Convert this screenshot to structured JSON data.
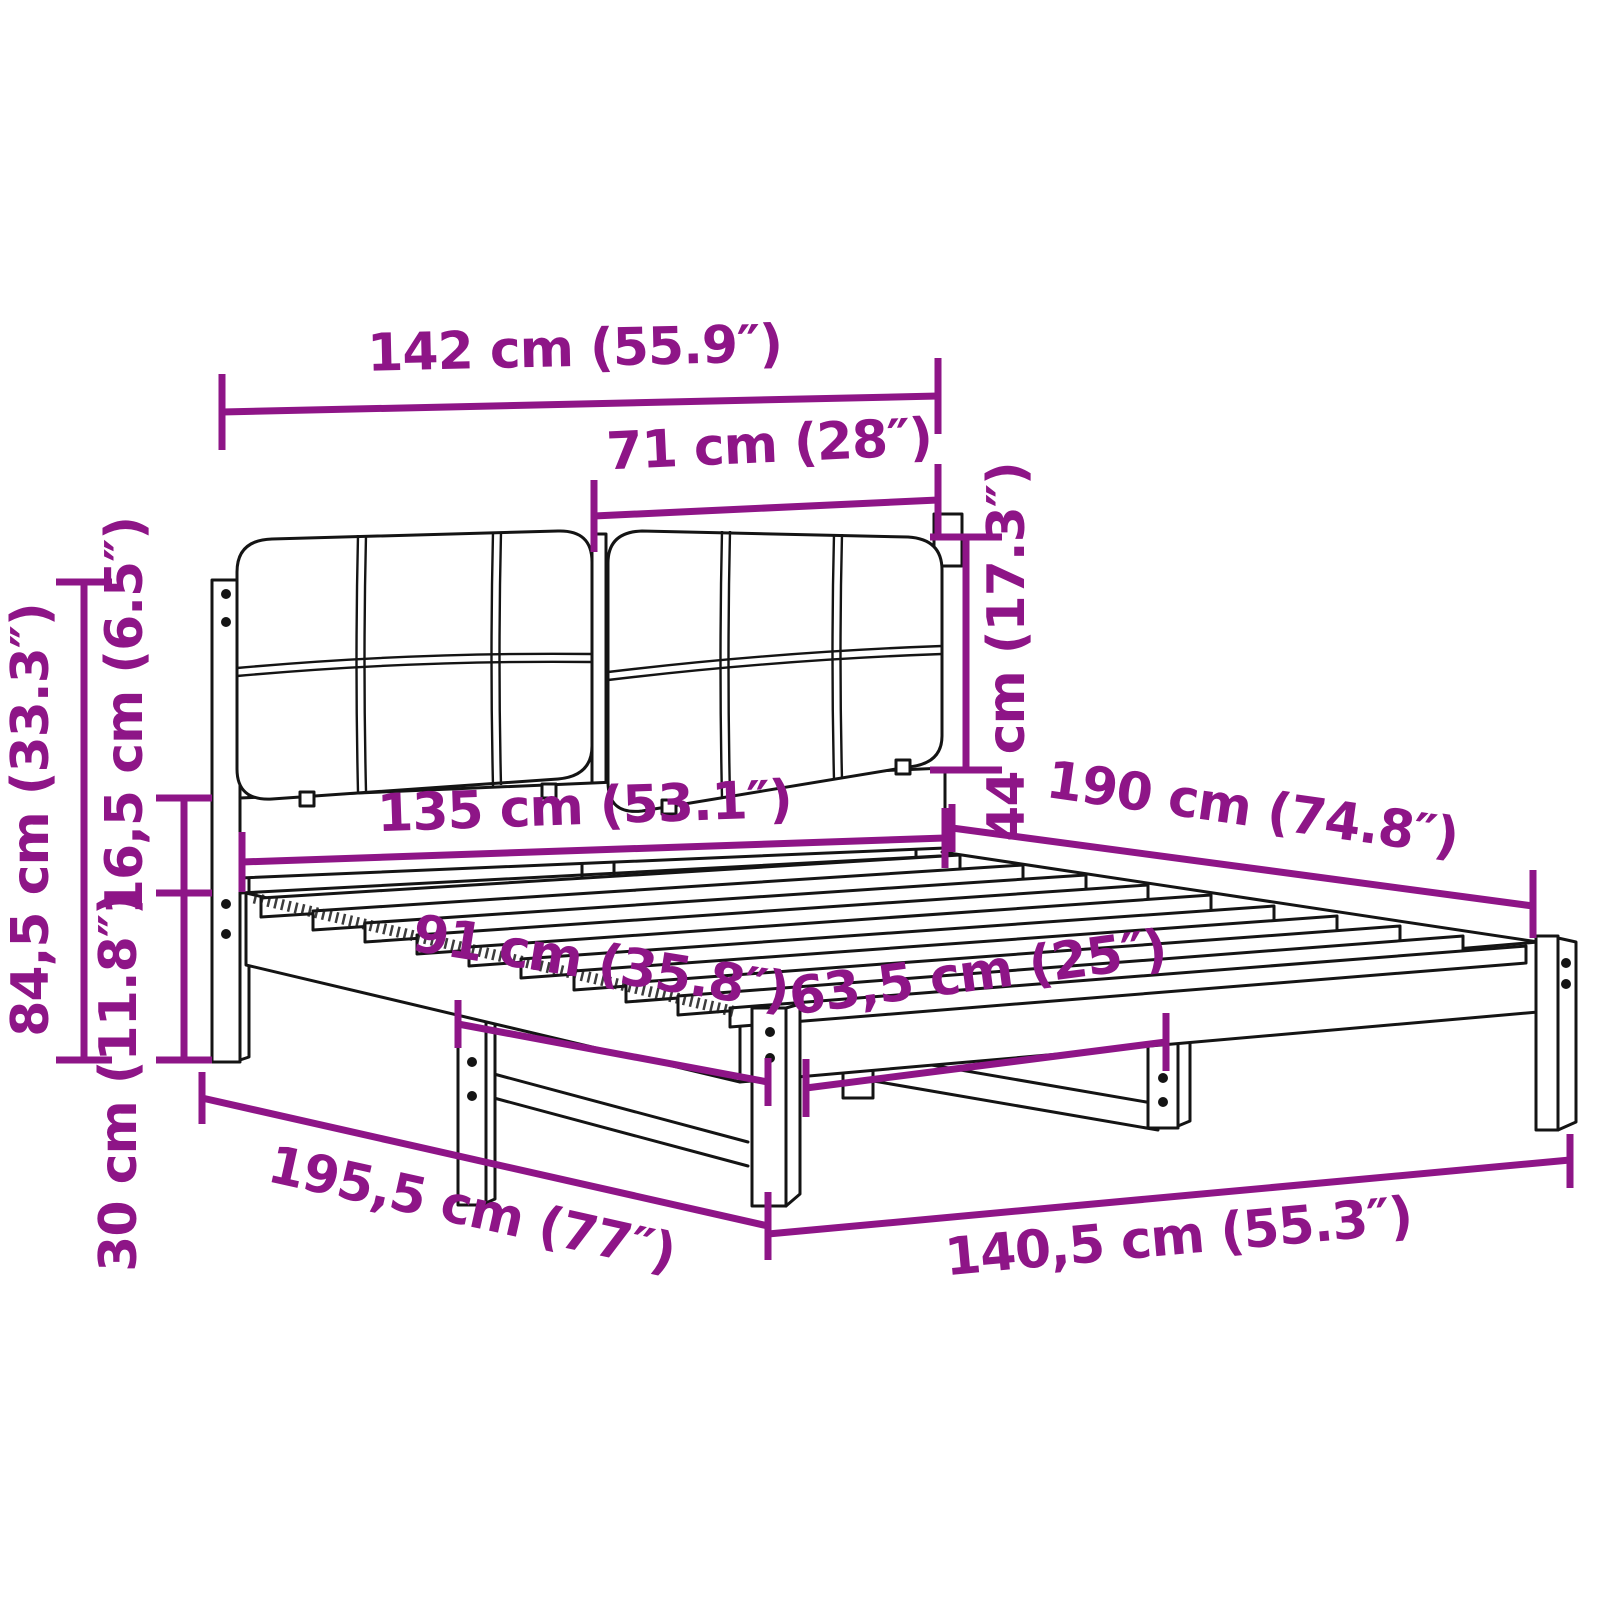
{
  "diagram": {
    "type": "product-dimension-diagram",
    "subject": "bed frame with upholstered tufted headboard and slatted base",
    "colors": {
      "dimension_accent": "#8E1587",
      "outline": "#141414",
      "background": "#FFFFFF"
    },
    "dimensions": {
      "headboard_total_width": {
        "label": "142 cm (55.9″)",
        "cm": "142",
        "inches": "55.9"
      },
      "cushion_panel_width": {
        "label": "71 cm (28″)",
        "cm": "71",
        "inches": "28"
      },
      "cushion_height": {
        "label": "44 cm (17.3″)",
        "cm": "44",
        "inches": "17.3"
      },
      "mattress_length": {
        "label": "190 cm (74.8″)",
        "cm": "190",
        "inches": "74.8"
      },
      "total_height": {
        "label": "84,5 cm (33.3″)",
        "cm": "84,5",
        "inches": "33.3"
      },
      "rail_height": {
        "label": "16,5 cm (6.5″)",
        "cm": "16,5",
        "inches": "6.5"
      },
      "base_height": {
        "label": "30 cm (11.8″)",
        "cm": "30",
        "inches": "11.8"
      },
      "mattress_width": {
        "label": "135 cm (53.1″)",
        "cm": "135",
        "inches": "53.1"
      },
      "side_leg_spacing": {
        "label": "91 cm (35.8″)",
        "cm": "91",
        "inches": "35.8"
      },
      "front_leg_spacing": {
        "label": "63,5 cm (25″)",
        "cm": "63,5",
        "inches": "25"
      },
      "frame_total_length": {
        "label": "195,5 cm (77″)",
        "cm": "195,5",
        "inches": "77"
      },
      "frame_total_width": {
        "label": "140,5 cm (55.3″)",
        "cm": "140,5",
        "inches": "55.3"
      }
    }
  }
}
